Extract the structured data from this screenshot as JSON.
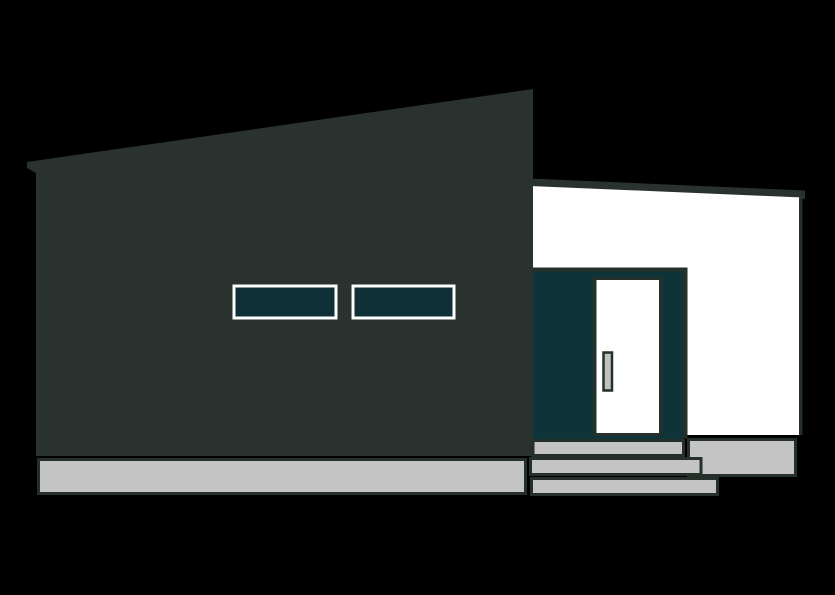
{
  "scene": {
    "type": "flat-vector-illustration",
    "subject": "modern single-storey house with slanted shed roof, two horizontal ribbon windows, white annex wing with recessed entry, front door and concrete steps",
    "background_color": "#000000"
  },
  "colors": {
    "background": "#000000",
    "facade": "#29322e",
    "outline": "#26302b",
    "glass": "#0e3036",
    "recess": "#0e3338",
    "wall_white": "#ffffff",
    "door": "#ffffff",
    "window_frame": "#ffffff",
    "concrete": "#c3c4c3",
    "handle_fill": "#c0c2c1"
  },
  "parts": {
    "main_facade": "dark slanted-roof facade block",
    "annex_roof": "thin dark roof band sloping right",
    "annex_wall": "white side wing wall",
    "entry_recess": "dark teal recessed entry",
    "front_door": "white entry door",
    "door_handle": "vertical door handle",
    "window_left": "left ribbon window",
    "window_right": "right ribbon window",
    "base_foundation": "concrete foundation slab",
    "porch_landing": "concrete porch landing",
    "steps": [
      "top step",
      "middle step",
      "bottom step"
    ]
  }
}
